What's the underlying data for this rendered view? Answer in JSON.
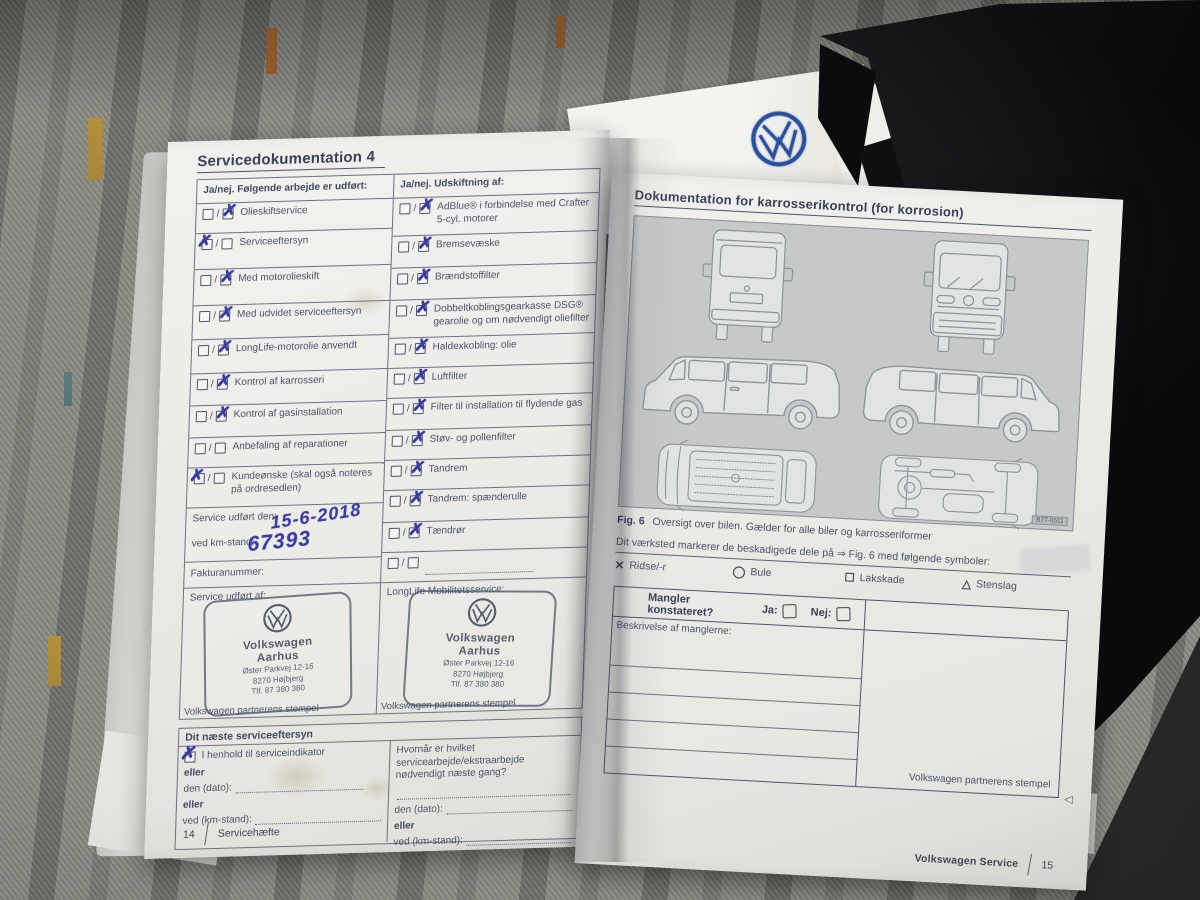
{
  "colors": {
    "ink": "#3b3ca2",
    "print": "#49536b",
    "paper": "#edebe6",
    "vw_blue": "#2a4f9f"
  },
  "left_page": {
    "title": "Servicedokumentation 4",
    "work_header": "Ja/nej. Følgende arbejde er udført:",
    "work_items": [
      {
        "label": "Olieskiftservice",
        "checked": "nej"
      },
      {
        "label": "Serviceeftersyn",
        "checked": "ja"
      },
      {
        "label": "Med motorolieskift",
        "checked": "nej"
      },
      {
        "label": "Med udvidet serviceeftersyn",
        "checked": "nej"
      },
      {
        "label": "LongLife-motorolie anvendt",
        "checked": "nej"
      },
      {
        "label": "Kontrol af karrosseri",
        "checked": "nej"
      },
      {
        "label": "Kontrol af gasinstallation",
        "checked": "nej"
      },
      {
        "label": "Anbefaling af reparationer",
        "checked": "none"
      },
      {
        "label": "Kundeønske (skal også noteres på ordresedlen)",
        "checked": "ja"
      }
    ],
    "replace_header": "Ja/nej. Udskiftning af:",
    "replace_items": [
      {
        "label": "AdBlue® i forbindelse med Crafter 5-cyl. motorer",
        "checked": "nej"
      },
      {
        "label": "Bremsevæske",
        "checked": "nej"
      },
      {
        "label": "Brændstoffilter",
        "checked": "nej"
      },
      {
        "label": "Dobbeltkoblingsgearkasse DSG® gearolie og om nødvendigt oliefilter",
        "checked": "nej"
      },
      {
        "label": "Haldexkobling: olie",
        "checked": "nej"
      },
      {
        "label": "Luftfilter",
        "checked": "nej"
      },
      {
        "label": "Filter til installation til flydende gas",
        "checked": "nej"
      },
      {
        "label": "Støv- og pollenfilter",
        "checked": "nej"
      },
      {
        "label": "Tandrem",
        "checked": "nej"
      },
      {
        "label": "Tandrem: spænderulle",
        "checked": "nej"
      },
      {
        "label": "Tændrør",
        "checked": "nej"
      },
      {
        "label": "",
        "checked": "none"
      }
    ],
    "service_done_label": "Service udført den:",
    "service_done_value": "15-6-2018",
    "km_label": "ved km-stand:",
    "km_value": "67393",
    "invoice_label": "Fakturanummer:",
    "service_by_label": "Service udført af:",
    "longlife_label": "LongLife Mobilitetsservice:",
    "stamp": {
      "brand": "Volkswagen",
      "city": "Aarhus",
      "street": "Øster Parkvej 12-16",
      "zip": "8270 Højbjerg",
      "phone": "Tlf. 87 380 380"
    },
    "stamp_caption": "Volkswagen partnerens stempel",
    "next_service": {
      "title": "Dit næste serviceeftersyn",
      "left_option": "I henhold til serviceindikator",
      "left_option_checked": true,
      "eller": "eller",
      "date_label": "den (dato):",
      "km_label": "ved (km-stand):",
      "right_question": "Hvornår er hvilket servicearbejde/ekstraarbejde nødvendigt næste gang?"
    },
    "footer_page": "14",
    "footer_label": "Servicehæfte"
  },
  "right_page": {
    "title": "Dokumentation for karrosserikontrol (for korrosion)",
    "figure_views": [
      "van-rear-view",
      "van-front-view",
      "van-side-left-view",
      "van-side-right-view",
      "van-top-view",
      "van-underside-view"
    ],
    "figure_code": "B7T-0511",
    "caption_fig": "Fig. 6",
    "caption_text": "Oversigt over bilen. Gælder for alle biler og karrosseriformer",
    "marker_sentence": "Dit værksted markerer de beskadigede dele på ⇒ Fig. 6 med følgende symboler:",
    "symbols": [
      {
        "glyph": "✕",
        "label": "Ridse/-r"
      },
      {
        "glyph": "◯",
        "label": "Bule"
      },
      {
        "glyph": "☐",
        "label": "Lakskade"
      },
      {
        "glyph": "△",
        "label": "Stenslag"
      }
    ],
    "defects": {
      "question": "Mangler konstateret?",
      "ja_label": "Ja:",
      "nej_label": "Nej:",
      "desc_label": "Beskrivelse af manglerne:",
      "stamp_caption": "Volkswagen partnerens stempel"
    },
    "footer_label": "Volkswagen Service",
    "footer_page": "15"
  }
}
